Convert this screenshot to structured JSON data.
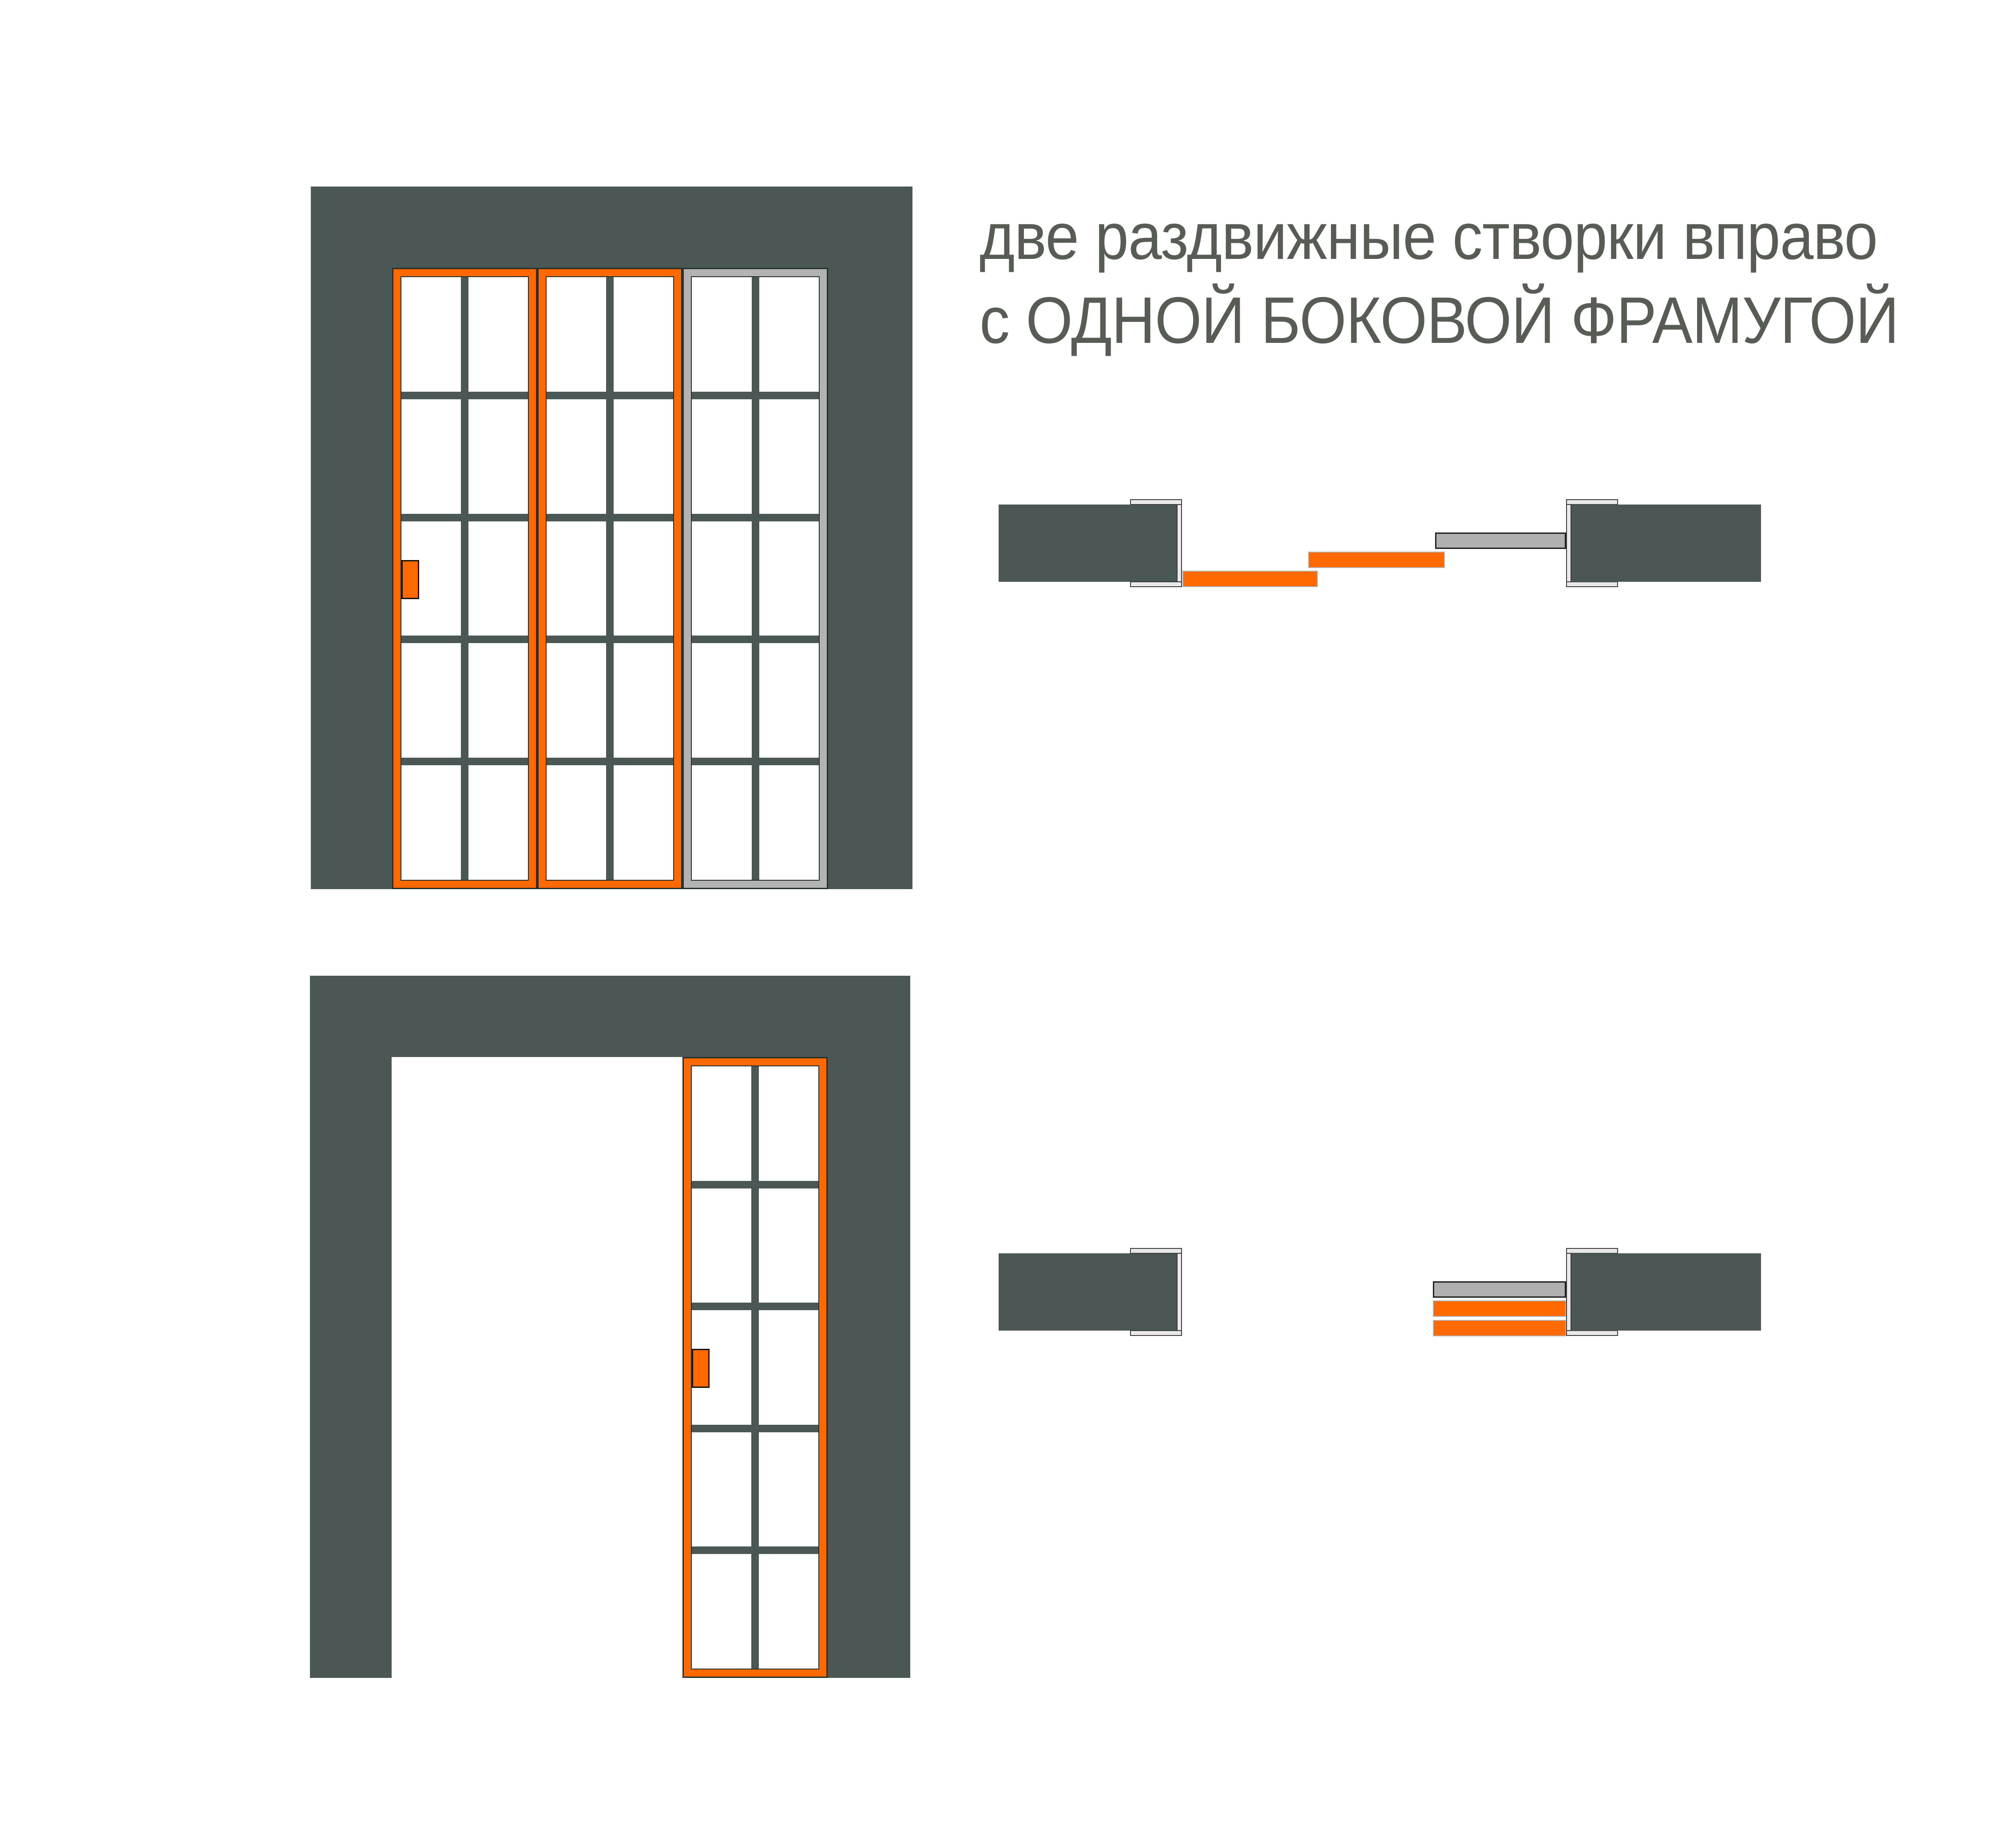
{
  "title": {
    "line1": "две раздвижные створки вправо",
    "line2": "с ОДНОЙ БОКОВОЙ ФРАМУГОЙ"
  },
  "colors": {
    "wall": "#4b5754",
    "sliding_leaf_orange": "#ff6900",
    "side_transom_gray": "#b3b3b3",
    "track_jamb_light_gray": "#e9e9e9",
    "glass_pane": "#ffffff",
    "outline_dark": "#26302d",
    "title_text": "#575c55",
    "background": "#ffffff"
  }
}
